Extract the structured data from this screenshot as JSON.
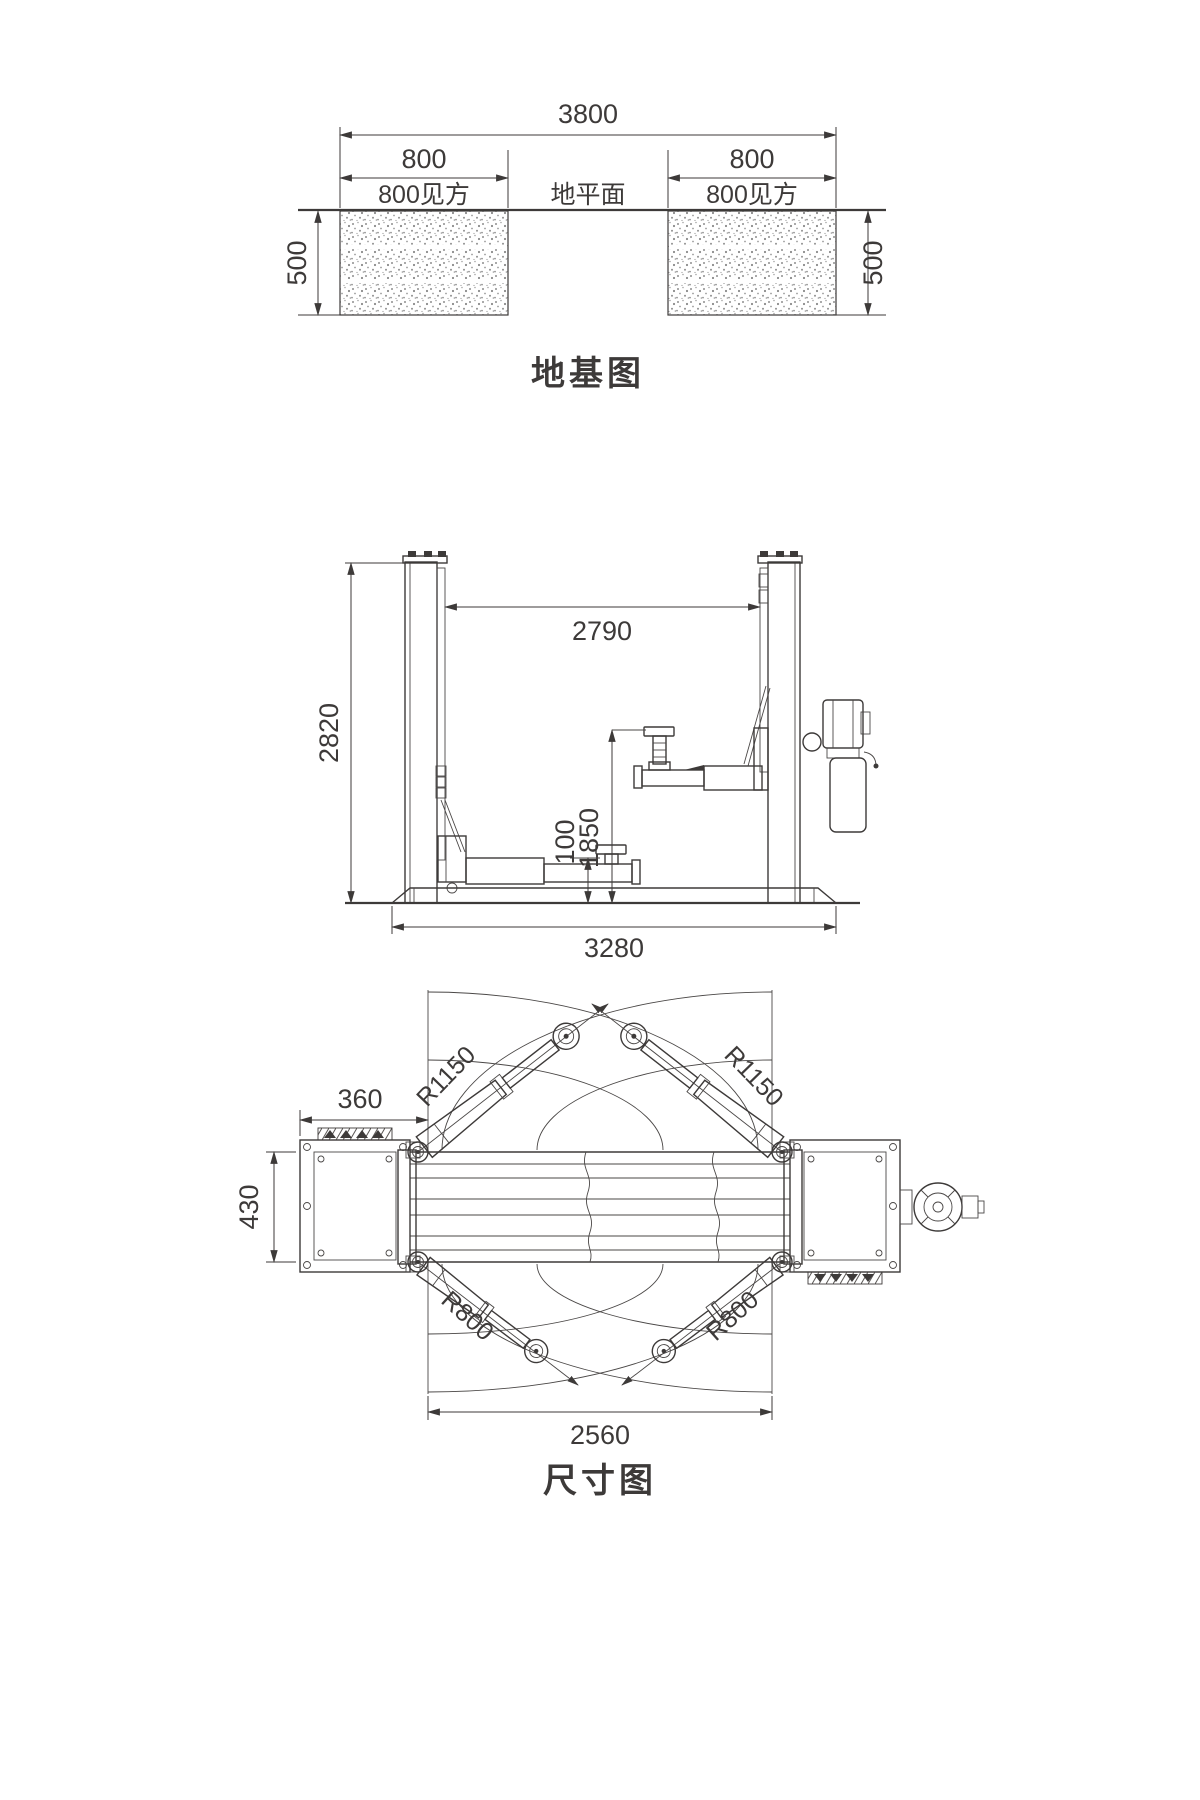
{
  "drawing": {
    "line_color": "#3d3a39",
    "foundation": {
      "title": "地基图",
      "overall_width": "3800",
      "pad_width_left": "800",
      "pad_width_right": "800",
      "pad_square_left": "800见方",
      "pad_square_right": "800见方",
      "ground_plane": "地平面",
      "depth_left": "500",
      "depth_right": "500"
    },
    "elevation": {
      "overall_height": "2820",
      "clear_inner_width": "2790",
      "max_lift_height": "1850",
      "min_pad_height": "100",
      "base_width": "3280"
    },
    "plan": {
      "title": "尺寸图",
      "column_base_width": "360",
      "column_base_depth": "430",
      "long_arm_radius_left": "R1150",
      "long_arm_radius_right": "R1150",
      "short_arm_radius_left": "R800",
      "short_arm_radius_right": "R800",
      "inner_clearance": "2560"
    }
  }
}
